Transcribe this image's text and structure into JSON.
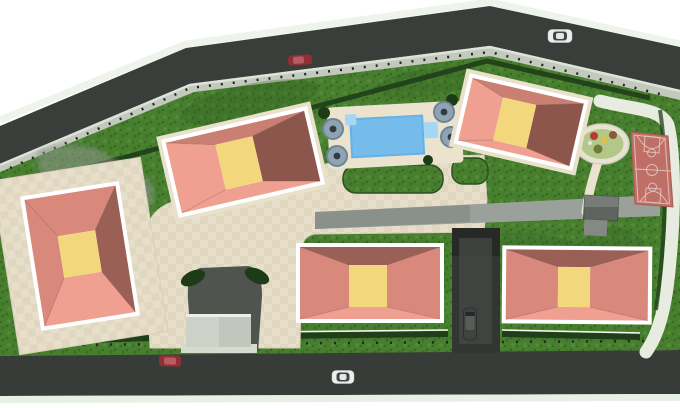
{
  "scene": {
    "kind": "architectural-site-plan-3d-render",
    "view": "top-down"
  },
  "objects": {
    "buildings": 5,
    "cars": 5,
    "pool_umbrellas": 4,
    "swimming_pool": 1,
    "basketball_court": 1,
    "playground": 1,
    "guard_house": 1,
    "garage_ramp": 1,
    "shed": 1
  },
  "palette": {
    "background": "#ffffff",
    "halo": "#eef3ec",
    "road": "#3a3e3a",
    "road_bottom": "#383c38",
    "curb_light": "#dce3d8",
    "sidewalk": "#c3cabd",
    "sidewalk_bottom": "#ddd7c5",
    "strip": "#e7f0e4",
    "fence": "#24271f",
    "hedge": "#1f3e19",
    "wall": "#f6f8f3",
    "grass": "#477f2f",
    "grass_dark": "#3c6f26",
    "grass_light": "#528c3a",
    "plaza": "#e8dfca",
    "plaza_alt": "#e0d7c1",
    "pad": "#eae1cc",
    "deck": "#ece3cf",
    "path_gray": "#9aa19a",
    "path_gray_dark": "#868d86",
    "shadow": "#8e958f",
    "pool": "#65b2e5",
    "pool_light": "#7ec2ee",
    "pool_step": "#a5d6f3",
    "umbrella": "#8fa3b3",
    "umbrella_rim": "#6d8496",
    "umbrella_center": "#2e3b45",
    "bush": "#1d3b16",
    "playground_ring": "#e7e3d2",
    "playground_green": "#b3c788",
    "eq_red": "#b83a30",
    "eq_brown": "#8a5a38",
    "eq_yellow": "#ddc14e",
    "eq_olive": "#6d7a3a",
    "court": "#bf6f66",
    "court_line": "#debfb8",
    "shed": "#5f645f",
    "shed_light": "#848984",
    "driveway": "#50544e",
    "ramp": "#323531",
    "ramp_dark": "#262926",
    "ramp_mid": "#444743",
    "guard_left": "#cdd2c8",
    "guard_right": "#c2c7bd",
    "guard_base": "#d6dacf",
    "car_red": "#8f3036",
    "car_red_top": "#b95c60",
    "car_white": "#eceeec",
    "car_cabin": "#41464a",
    "car_dark": "#3f4440",
    "car_dark_cabin": "#585d58",
    "roof_light": "#f0a090",
    "roof_mid": "#d8897c",
    "roof_mid2": "#c97f72",
    "roof_dark": "#9a5f55",
    "roof_deep": "#8c564c",
    "roof_yellow": "#f3d77d",
    "building_outline": "#ffffff"
  }
}
